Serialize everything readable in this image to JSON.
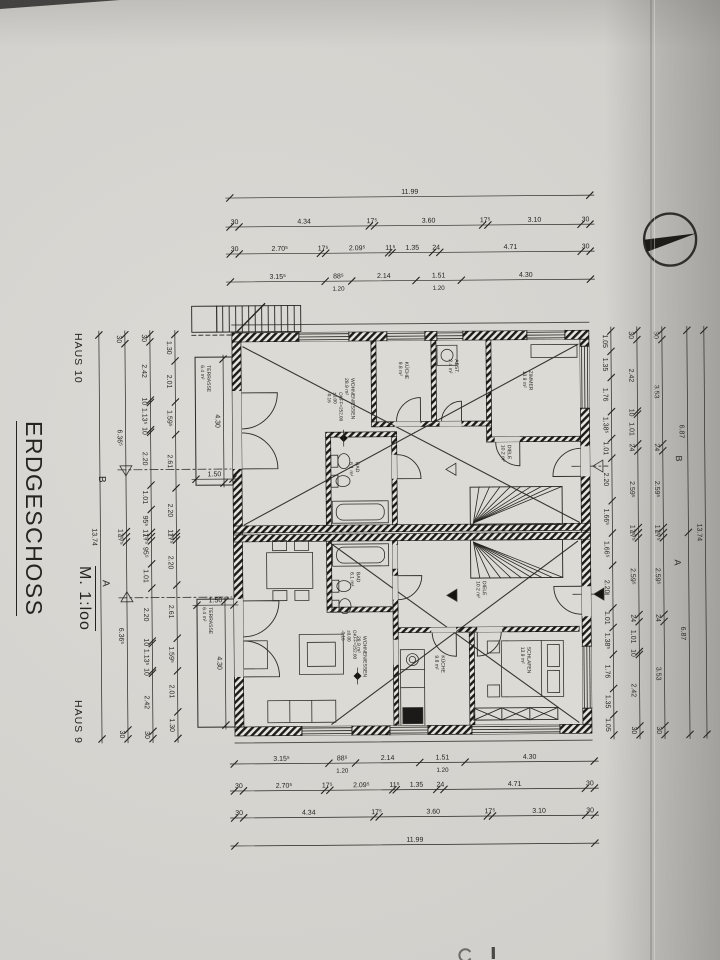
{
  "page": {
    "haus_top": "HAUS 10",
    "haus_bottom": "HAUS 9",
    "title": "ERDGESCHOSS",
    "scale": "M. 1:loo"
  },
  "sections": {
    "a": "A",
    "b": "B"
  },
  "levels": [
    {
      "x": 340,
      "y": 392,
      "lines": [
        "OKFF=252.00",
        "±0.00",
        "-0.16"
      ]
    },
    {
      "x": 352,
      "y": 630,
      "lines": [
        "OKFF=252.00",
        "±0.00",
        "-0.16"
      ]
    }
  ],
  "rooms": [
    {
      "x": 352,
      "y": 378,
      "lines": [
        "WOHNEN/ESSEN",
        "28.9 m²"
      ]
    },
    {
      "x": 406,
      "y": 362,
      "lines": [
        "KÜCHE",
        "9.8 m²"
      ]
    },
    {
      "x": 456,
      "y": 360,
      "lines": [
        "ABST.",
        "2.4 m²"
      ]
    },
    {
      "x": 530,
      "y": 372,
      "lines": [
        "ZIMMER",
        "13.9 m²"
      ]
    },
    {
      "x": 356,
      "y": 462,
      "lines": [
        "BAD",
        "6.1 m²"
      ]
    },
    {
      "x": 508,
      "y": 446,
      "lines": [
        "DIELE",
        "10.2 m²"
      ]
    },
    {
      "x": 362,
      "y": 636,
      "lines": [
        "WOHNEN/ESSEN",
        "28.9 m²"
      ]
    },
    {
      "x": 356,
      "y": 572,
      "lines": [
        "BAD",
        "6.1 m²"
      ]
    },
    {
      "x": 440,
      "y": 656,
      "lines": [
        "KÜCHE",
        "9.8 m²"
      ]
    },
    {
      "x": 526,
      "y": 648,
      "lines": [
        "SCHLAFEN",
        "13.9 m²"
      ]
    },
    {
      "x": 482,
      "y": 582,
      "lines": [
        "DIELE",
        "10.2 m²"
      ]
    },
    {
      "x": 208,
      "y": 364,
      "lines": [
        "TERRASSE",
        "6.4 m²"
      ]
    },
    {
      "x": 208,
      "y": 606,
      "lines": [
        "TERRASSE",
        "6.4 m²"
      ]
    }
  ],
  "dims": {
    "top": [
      {
        "y": 197,
        "x1": 232,
        "x2": 592,
        "segs": [
          {
            "t": "11.99",
            "v": 11.99
          }
        ]
      },
      {
        "y": 226,
        "x1": 232,
        "x2": 592,
        "segs": [
          {
            "t": "30",
            "v": 0.3
          },
          {
            "t": "4.34",
            "v": 4.34
          },
          {
            "t": "17⁵",
            "v": 0.175
          },
          {
            "t": "3.60",
            "v": 3.6
          },
          {
            "t": "17⁵",
            "v": 0.175
          },
          {
            "t": "3.10",
            "v": 3.1
          },
          {
            "t": "30",
            "v": 0.3
          }
        ]
      },
      {
        "y": 253,
        "x1": 232,
        "x2": 592,
        "segs": [
          {
            "t": "30",
            "v": 0.3
          },
          {
            "t": "2.70⁵",
            "v": 2.705
          },
          {
            "t": "17⁵",
            "v": 0.175
          },
          {
            "t": "2.09⁵",
            "v": 2.095
          },
          {
            "t": "11⁵",
            "v": 0.115
          },
          {
            "t": "1.35",
            "v": 1.35
          },
          {
            "t": "24",
            "v": 0.24
          },
          {
            "t": "4.71",
            "v": 4.71
          },
          {
            "t": "30",
            "v": 0.3
          }
        ]
      },
      {
        "y": 281,
        "x1": 232,
        "x2": 592,
        "segs": [
          {
            "t": "3.15⁵",
            "v": 3.155
          },
          {
            "t": "88⁵",
            "v": 0.885,
            "sub": "1.20"
          },
          {
            "t": "2.14",
            "v": 2.14
          },
          {
            "t": "1.51",
            "v": 1.51,
            "sub": "1.20"
          },
          {
            "t": "4.30",
            "v": 4.3
          }
        ]
      }
    ],
    "bottom": [
      {
        "y": 763,
        "x1": 232,
        "x2": 592,
        "segs": [
          {
            "t": "3.15⁵",
            "v": 3.155
          },
          {
            "t": "88⁵",
            "v": 0.885,
            "sub": "1.20"
          },
          {
            "t": "2.14",
            "v": 2.14
          },
          {
            "t": "1.51",
            "v": 1.51,
            "sub": "1.20"
          },
          {
            "t": "4.30",
            "v": 4.3
          }
        ]
      },
      {
        "y": 790,
        "x1": 232,
        "x2": 592,
        "segs": [
          {
            "t": "30",
            "v": 0.3
          },
          {
            "t": "2.70⁵",
            "v": 2.705
          },
          {
            "t": "17⁵",
            "v": 0.175
          },
          {
            "t": "2.09⁵",
            "v": 2.095
          },
          {
            "t": "11⁵",
            "v": 0.115
          },
          {
            "t": "1.35",
            "v": 1.35
          },
          {
            "t": "24",
            "v": 0.24
          },
          {
            "t": "4.71",
            "v": 4.71
          },
          {
            "t": "30",
            "v": 0.3
          }
        ]
      },
      {
        "y": 817,
        "x1": 232,
        "x2": 592,
        "segs": [
          {
            "t": "30",
            "v": 0.3
          },
          {
            "t": "4.34",
            "v": 4.34
          },
          {
            "t": "17⁵",
            "v": 0.175
          },
          {
            "t": "3.60",
            "v": 3.6
          },
          {
            "t": "17⁵",
            "v": 0.175
          },
          {
            "t": "3.10",
            "v": 3.1
          },
          {
            "t": "30",
            "v": 0.3
          }
        ]
      },
      {
        "y": 845,
        "x1": 232,
        "x2": 592,
        "segs": [
          {
            "t": "11.99",
            "v": 11.99
          }
        ]
      }
    ],
    "left": [
      {
        "x": 100,
        "y1": 333,
        "y2": 737,
        "segs": [
          {
            "t": "13.74",
            "v": 13.74
          }
        ]
      },
      {
        "x": 126,
        "y1": 333,
        "y2": 737,
        "segs": [
          {
            "t": "30",
            "v": 0.3
          },
          {
            "t": "6.36⁵",
            "v": 6.365
          },
          {
            "t": "17⁵",
            "v": 0.175
          },
          {
            "t": "17⁵",
            "v": 0.175
          },
          {
            "t": "6.36⁵",
            "v": 6.365
          },
          {
            "t": "30",
            "v": 0.3
          }
        ]
      },
      {
        "x": 151,
        "y1": 333,
        "y2": 737,
        "segs": [
          {
            "t": "30",
            "v": 0.3
          },
          {
            "t": "2.42",
            "v": 2.42
          },
          {
            "t": "10",
            "v": 0.1
          },
          {
            "t": "1.13⁵",
            "v": 1.135
          },
          {
            "t": "10",
            "v": 0.1
          },
          {
            "t": "2.20",
            "v": 2.2
          },
          {
            "t": "1.01",
            "v": 1.01
          },
          {
            "t": "95⁵",
            "v": 0.955
          },
          {
            "t": "17⁵",
            "v": 0.175
          },
          {
            "t": "17⁵",
            "v": 0.175
          },
          {
            "t": "95⁵",
            "v": 0.955
          },
          {
            "t": "1.01",
            "v": 1.01
          },
          {
            "t": "2.20",
            "v": 2.2
          },
          {
            "t": "10",
            "v": 0.1
          },
          {
            "t": "1.13⁵",
            "v": 1.135
          },
          {
            "t": "10",
            "v": 0.1
          },
          {
            "t": "2.42",
            "v": 2.42
          },
          {
            "t": "30",
            "v": 0.3
          }
        ]
      },
      {
        "x": 176,
        "y1": 333,
        "y2": 737,
        "segs": [
          {
            "t": "1.30",
            "v": 1.3
          },
          {
            "t": "2.01",
            "v": 2.01
          },
          {
            "t": "1.59⁵",
            "v": 1.595
          },
          {
            "t": "2.61",
            "v": 2.61
          },
          {
            "t": "2.20",
            "v": 2.2
          },
          {
            "t": "17⁵",
            "v": 0.175
          },
          {
            "t": "17⁵",
            "v": 0.175
          },
          {
            "t": "2.20",
            "v": 2.2
          },
          {
            "t": "2.61",
            "v": 2.61
          },
          {
            "t": "1.59⁵",
            "v": 1.595
          },
          {
            "t": "2.01",
            "v": 2.01
          },
          {
            "t": "1.30",
            "v": 1.3
          }
        ]
      }
    ],
    "right": [
      {
        "x": 612,
        "y1": 333,
        "y2": 737,
        "segs": [
          {
            "t": "1.05",
            "v": 1.05
          },
          {
            "t": "1.35",
            "v": 1.35
          },
          {
            "t": "1.76",
            "v": 1.76
          },
          {
            "t": "1.38⁵",
            "v": 1.385
          },
          {
            "t": "1.01",
            "v": 1.01
          },
          {
            "t": "2.20",
            "v": 2.2
          },
          {
            "t": "1.66⁵",
            "v": 1.665
          },
          {
            "t": "1.66⁵",
            "v": 1.665
          },
          {
            "t": "2.20",
            "v": 2.2
          },
          {
            "t": "1.01",
            "v": 1.01
          },
          {
            "t": "1.38⁵",
            "v": 1.385
          },
          {
            "t": "1.76",
            "v": 1.76
          },
          {
            "t": "1.35",
            "v": 1.35
          },
          {
            "t": "1.05",
            "v": 1.05
          }
        ]
      },
      {
        "x": 638,
        "y1": 333,
        "y2": 737,
        "segs": [
          {
            "t": "30",
            "v": 0.3
          },
          {
            "t": "2.42",
            "v": 2.42
          },
          {
            "t": "10",
            "v": 0.1
          },
          {
            "t": "1.01",
            "v": 1.01
          },
          {
            "t": "24",
            "v": 0.24
          },
          {
            "t": "2.59⁵",
            "v": 2.595
          },
          {
            "t": "17⁵",
            "v": 0.175
          },
          {
            "t": "17⁵",
            "v": 0.175
          },
          {
            "t": "2.59⁵",
            "v": 2.595
          },
          {
            "t": "24",
            "v": 0.24
          },
          {
            "t": "1.01",
            "v": 1.01
          },
          {
            "t": "10",
            "v": 0.1
          },
          {
            "t": "2.42",
            "v": 2.42
          },
          {
            "t": "30",
            "v": 0.3
          }
        ]
      },
      {
        "x": 663,
        "y1": 333,
        "y2": 737,
        "segs": [
          {
            "t": "30",
            "v": 0.3
          },
          {
            "t": "3.53",
            "v": 3.53
          },
          {
            "t": "24",
            "v": 0.24
          },
          {
            "t": "2.59⁵",
            "v": 2.595
          },
          {
            "t": "17⁵",
            "v": 0.175
          },
          {
            "t": "17⁵",
            "v": 0.175
          },
          {
            "t": "2.59⁵",
            "v": 2.595
          },
          {
            "t": "24",
            "v": 0.24
          },
          {
            "t": "3.53",
            "v": 3.53
          },
          {
            "t": "30",
            "v": 0.3
          }
        ]
      },
      {
        "x": 688,
        "y1": 333,
        "y2": 737,
        "segs": [
          {
            "t": "6.87",
            "v": 6.87
          },
          {
            "t": "6.87",
            "v": 6.87
          }
        ]
      },
      {
        "x": 705,
        "y1": 333,
        "y2": 737,
        "segs": [
          {
            "t": "13.74",
            "v": 13.74
          }
        ]
      }
    ],
    "inner": [
      {
        "o": "v",
        "x": 224,
        "y1": 358,
        "y2": 482,
        "t": "4.30"
      },
      {
        "o": "h",
        "y": 478,
        "x1": 196,
        "x2": 233,
        "t": "1.50"
      },
      {
        "o": "v",
        "x": 224,
        "y1": 600,
        "y2": 724,
        "t": "4.30"
      },
      {
        "o": "h",
        "y": 604,
        "x1": 196,
        "x2": 233,
        "t": "1.50"
      }
    ]
  },
  "openings": {
    "top": [
      [
        300,
        350
      ],
      [
        388,
        426
      ],
      [
        438,
        464
      ],
      [
        528,
        566
      ]
    ],
    "bottom": [
      [
        300,
        350
      ],
      [
        388,
        426
      ],
      [
        470,
        558
      ]
    ],
    "right": [
      [
        348,
        410
      ],
      [
        648,
        710
      ]
    ],
    "right_doors": [
      [
        448,
        478
      ],
      [
        588,
        618
      ]
    ],
    "left_doors": [
      [
        390,
        468
      ],
      [
        598,
        676
      ]
    ],
    "inner_gaps": [
      [
        395,
        422,
        26,
        5
      ],
      [
        440,
        422,
        22,
        5
      ],
      [
        495,
        438,
        25,
        5
      ],
      [
        392,
        455,
        5,
        24
      ],
      [
        392,
        545,
        5,
        24
      ],
      [
        392,
        576,
        5,
        24
      ],
      [
        430,
        628,
        25,
        5
      ],
      [
        476,
        628,
        25,
        5
      ],
      [
        392,
        640,
        5,
        25
      ]
    ]
  },
  "colors": {
    "ink": "#26241f",
    "paper": "#d8d6d1",
    "wall_dark": "#1c1b18"
  }
}
